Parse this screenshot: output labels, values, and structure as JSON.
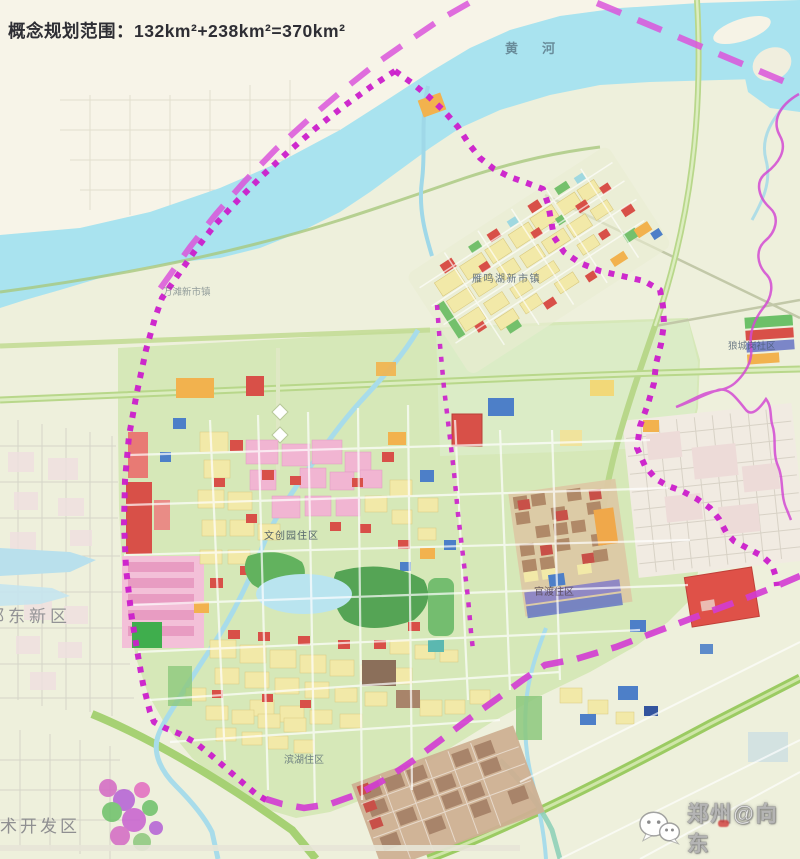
{
  "title": "概念规划范围：132km²+238km²=370km²",
  "map": {
    "river_label": "黄河",
    "labels": {
      "north_town": "雁鸣湖新市镇",
      "west_town": "万滩新市镇",
      "east_community": "狼城岗社区",
      "central_district": "文创园住区",
      "east_district": "官渡住区",
      "south_district": "滨湖住区",
      "west_region": "郑东新区",
      "southwest_region": "术开发区"
    },
    "legend_colors": {
      "boundary_magenta": "#cb1ecb",
      "boundary_dash_magenta": "#d33bd3",
      "river_blue": "#a9e3ef",
      "land_cream": "#f7f4e8",
      "land_olive": "#eef0dc",
      "field_green": "#d6e8b8",
      "parcel_yellow": "#f2e9a8",
      "parcel_red": "#d85048",
      "parcel_pink": "#f1b5d2",
      "parcel_orange": "#f2b24e",
      "parcel_blue": "#4d7fc8",
      "park_green": "#5aaa5a"
    }
  },
  "watermark": {
    "text": "郑州@向东",
    "icon": "wechat-icon"
  }
}
